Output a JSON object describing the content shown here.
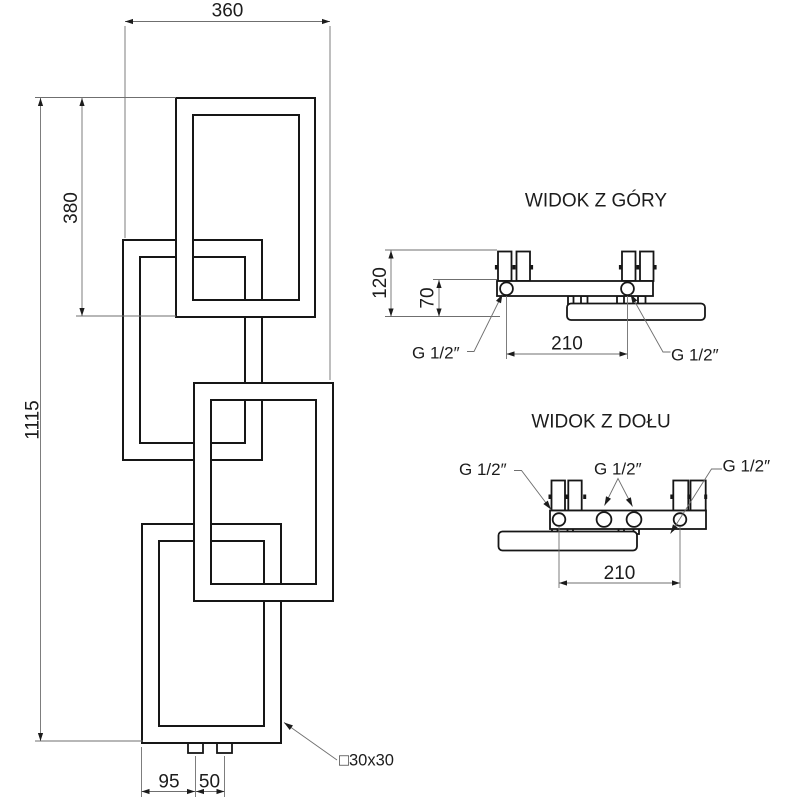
{
  "front_view": {
    "dim_width_top": "360",
    "dim_height_segment": "380",
    "dim_height_total": "1115",
    "dim_conn_offset": "95",
    "dim_conn_spacing": "50",
    "profile_label": "□30x30"
  },
  "top_view": {
    "title": "WIDOK Z GÓRY",
    "dim_depth": "120",
    "dim_wall_offset": "70",
    "dim_conn_spacing": "210",
    "thread_left": "G 1/2″",
    "thread_right": "G 1/2″"
  },
  "bottom_view": {
    "title": "WIDOK Z DOŁU",
    "dim_conn_spacing": "210",
    "thread_left": "G 1/2″",
    "thread_center": "G 1/2″",
    "thread_right": "G 1/2″"
  },
  "colors": {
    "object_line": "#161616",
    "dimension_line": "#6f6f6f",
    "text": "#1c1c1c",
    "background": "#ffffff"
  }
}
